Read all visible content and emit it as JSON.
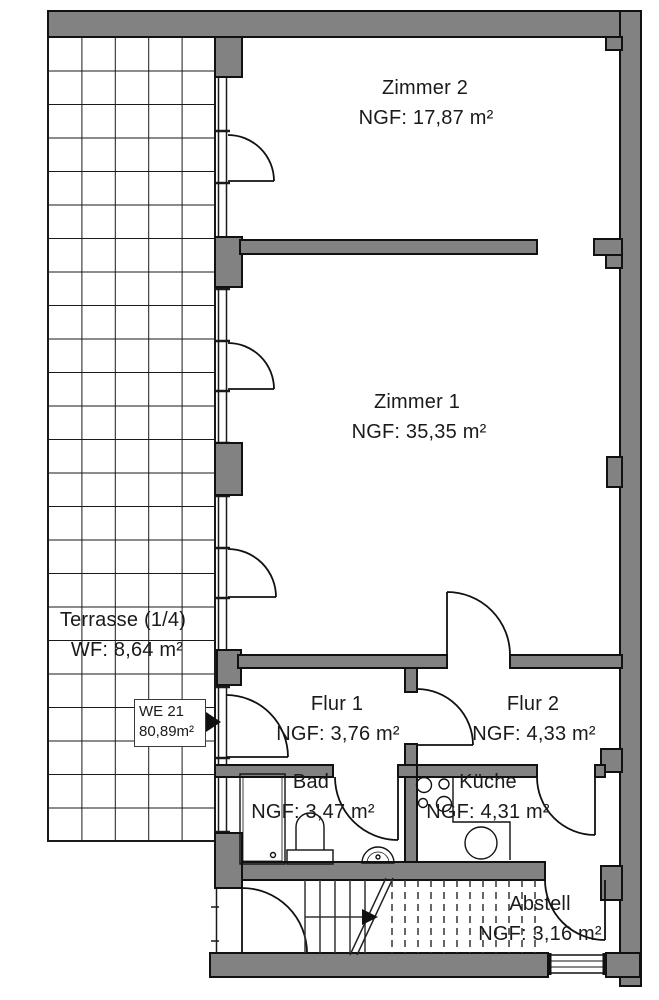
{
  "plan_type": "apartment-floor-plan",
  "colors": {
    "wall_fill": "#828282",
    "line": "#1a1a1a",
    "background": "#ffffff"
  },
  "unit_box": {
    "label": "WE 21",
    "area": "80,89m²"
  },
  "rooms": [
    {
      "key": "zimmer2",
      "name": "Zimmer 2",
      "area": "NGF: 17,87 m²"
    },
    {
      "key": "zimmer1",
      "name": "Zimmer 1",
      "area": "NGF: 35,35 m²"
    },
    {
      "key": "terrasse",
      "name": "Terrasse (1/4)",
      "area": "WF: 8,64 m²"
    },
    {
      "key": "flur1",
      "name": "Flur 1",
      "area": "NGF: 3,76 m²"
    },
    {
      "key": "flur2",
      "name": "Flur 2",
      "area": "NGF: 4,33 m²"
    },
    {
      "key": "bad",
      "name": "Bad",
      "area": "NGF: 3,47 m²"
    },
    {
      "key": "kueche",
      "name": "Küche",
      "area": "NGF: 4,31 m²"
    },
    {
      "key": "abstell",
      "name": "Abstell",
      "area": "NGF: 3,16 m²"
    }
  ],
  "icons": {
    "stairs_direction": "right-arrow",
    "unit_pointer": "right-triangle"
  }
}
